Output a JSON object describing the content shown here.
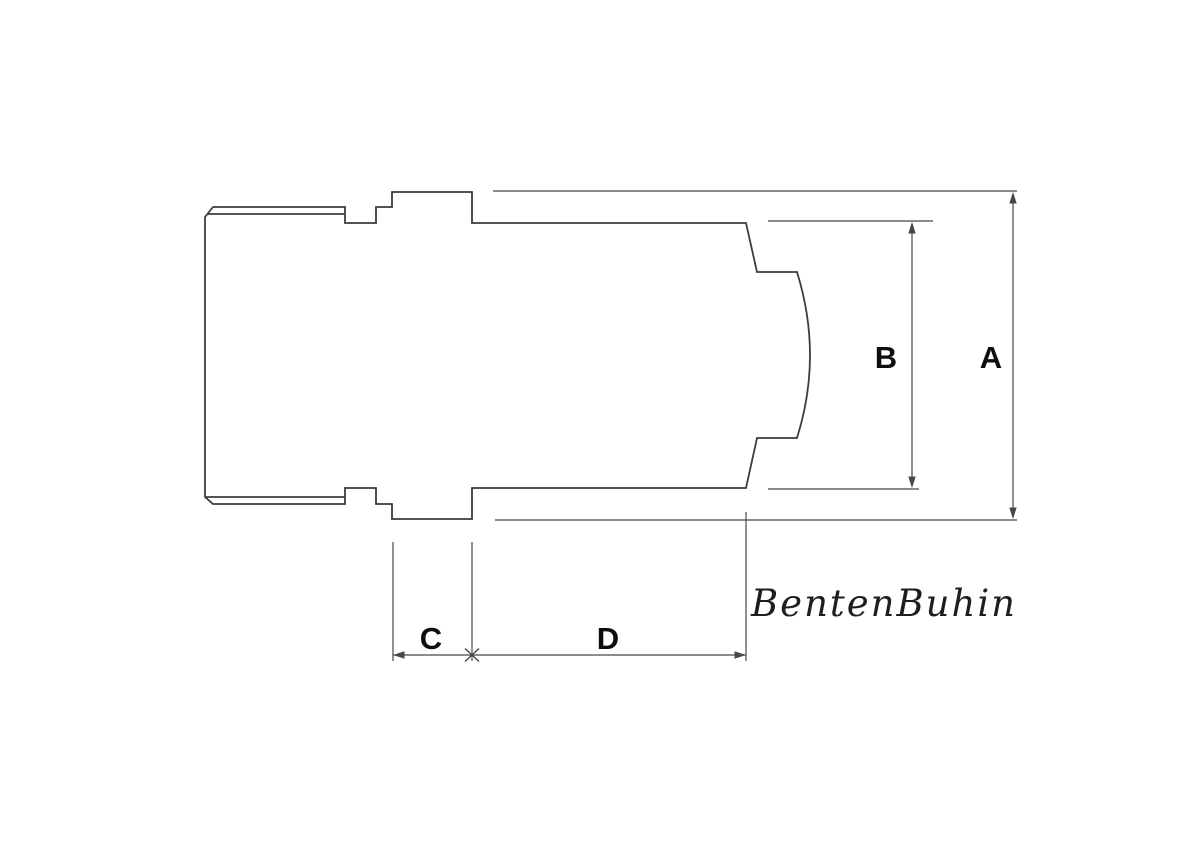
{
  "drawing": {
    "dimension_labels": {
      "a": "A",
      "b": "B",
      "c": "C",
      "d": "D"
    },
    "brand_text": "BentenBuhin",
    "colors": {
      "background": "#ffffff",
      "outline": "#3d3d3d",
      "dimension": "#474747",
      "label": "#0e0e0e",
      "brand": "#1e1e1e"
    }
  }
}
